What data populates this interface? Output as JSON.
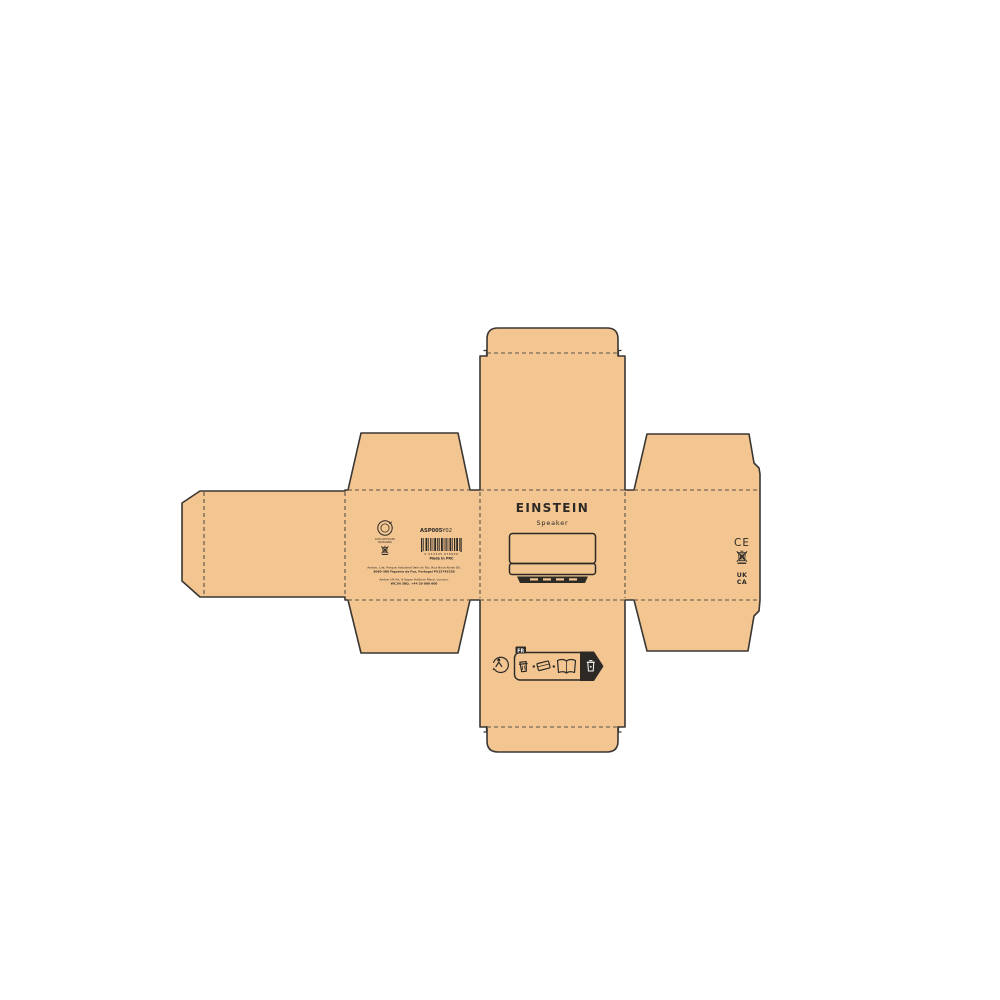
{
  "colors": {
    "kraft": "#F2C591",
    "outline": "#3A3632",
    "fold": "#5A5148",
    "ink": "#2D2A26",
    "bg": "#ffffff"
  },
  "front": {
    "brand": "EINSTEIN",
    "product": "Speaker"
  },
  "left": {
    "logo_caption_1": "100% RECYCLED",
    "logo_caption_2": "PACKAGING",
    "sku": "ASP005",
    "sku_suffix": "-Y02",
    "barcode_digits": "0 012345 678906",
    "made_in": "Made in PRC",
    "address1_line1": "Amber, Lda. Parque Industrial Vale do Rio, Rua Nova Norte 80,",
    "address1_line2": "3080-380 Figueira da Foz, Portugal P513745258",
    "address2_line1": "Amber UK ltd, 8 Upper Holborn Place, London,",
    "address2_line2": "WC1N 3BQ, +44 20 000 000"
  },
  "right": {
    "ce": "CE",
    "ukca_top": "UK",
    "ukca_bottom": "CA"
  },
  "bottom": {
    "fr": "FR"
  },
  "icons": {
    "left_logo": "recycle-circle-icon",
    "weee": "crossed-out-wheelie-bin-icon",
    "triman": "triman-recycling-icon",
    "sorting": [
      "cup-icon",
      "flat-box-icon",
      "leaflet-icon",
      "recycling-bin-icon"
    ]
  }
}
